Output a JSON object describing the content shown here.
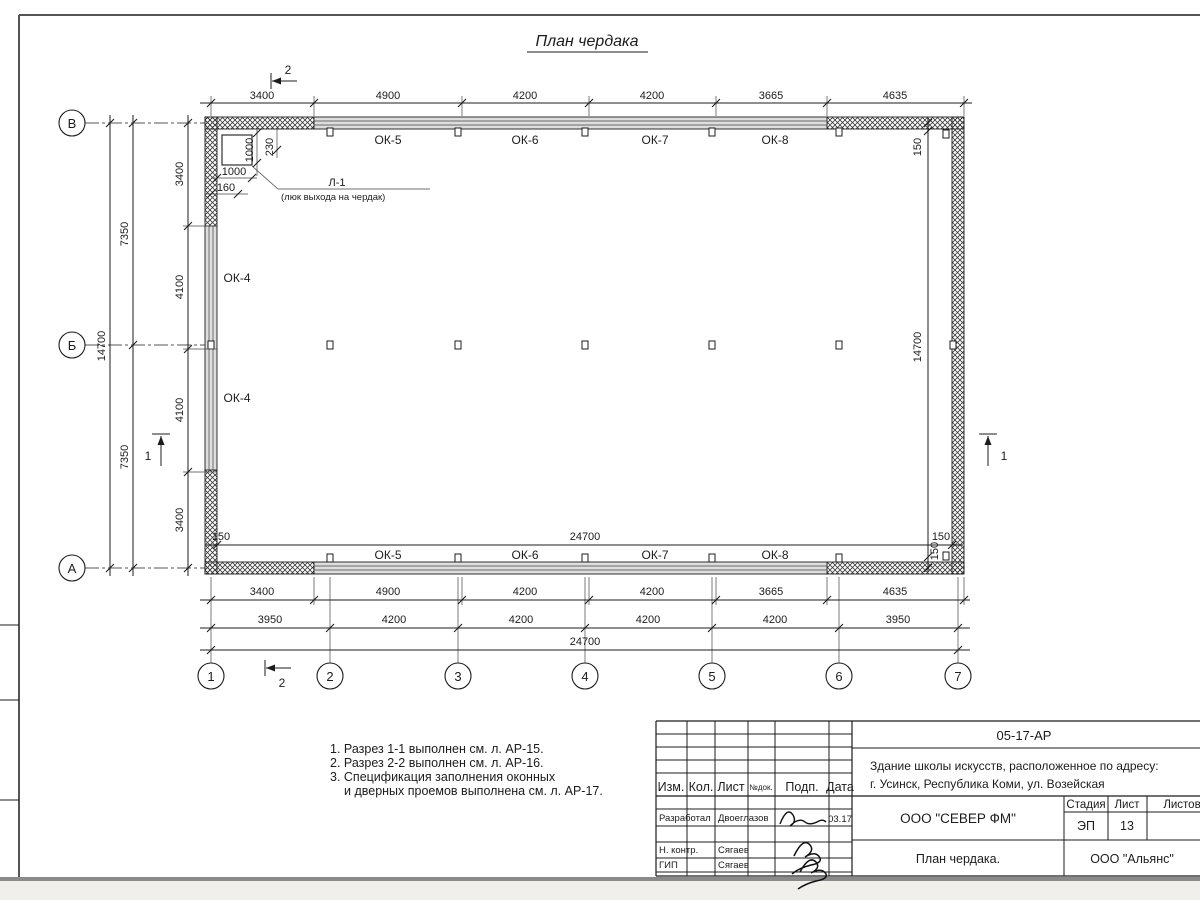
{
  "drawing": {
    "title": "План чердака"
  },
  "plan": {
    "axes_rows": [
      "В",
      "Б",
      "А"
    ],
    "axes_cols": [
      "1",
      "2",
      "3",
      "4",
      "5",
      "6",
      "7"
    ],
    "dims_top": [
      "3400",
      "4900",
      "4200",
      "4200",
      "3665",
      "4635"
    ],
    "dims_left_inner": [
      "3400",
      "4100",
      "4100",
      "3400"
    ],
    "dims_left_mid": [
      "7350",
      "7350"
    ],
    "dims_left_outer": "14700",
    "dims_right_inner": [
      "150",
      "14700",
      "150"
    ],
    "dims_inner_bottom": [
      "150",
      "24700",
      "150"
    ],
    "dims_bottom_row1": [
      "3400",
      "4900",
      "4200",
      "4200",
      "3665",
      "4635"
    ],
    "dims_bottom_row2": [
      "3950",
      "4200",
      "4200",
      "4200",
      "4200",
      "3950"
    ],
    "dims_bottom_total": "24700",
    "windows_top": [
      "ОК-5",
      "ОК-6",
      "ОК-7",
      "ОК-8"
    ],
    "windows_bottom": [
      "ОК-5",
      "ОК-6",
      "ОК-7",
      "ОК-8"
    ],
    "windows_left": [
      "ОК-4",
      "ОК-4"
    ],
    "roof_hatch": {
      "label": "Л-1",
      "note": "(люк выхода на чердак)",
      "dim_height": "1000",
      "dim_offset": "230",
      "dim_width": "1000",
      "dim_edge": "160"
    },
    "sections": {
      "s1": "1",
      "s2": "2"
    }
  },
  "notes": [
    "1. Разрез 1-1 выполнен см. л. АР-15.",
    "2. Разрез 2-2 выполнен см. л. АР-16.",
    "3. Спецификация заполнения оконных",
    "и дверных проемов выполнена см. л. АР-17."
  ],
  "titleblock": {
    "doc_code": "05-17-АР",
    "project_line1": "Здание школы искусств, расположенное по адресу:",
    "project_line2": "г. Усинск, Республика Коми, ул. Возейская",
    "cols": {
      "izm": "Изм.",
      "kol": "Кол.",
      "list": "Лист",
      "ndok": "№док.",
      "podp": "Подп.",
      "data": "Дата"
    },
    "rows": [
      {
        "role": "Разработал",
        "name": "Двоеглазов",
        "date": "03.17"
      },
      {
        "role": "Н. контр.",
        "name": "Сягаев"
      },
      {
        "role": "ГИП",
        "name": "Сягаев"
      }
    ],
    "stage_label": "Стадия",
    "sheet_label": "Лист",
    "sheets_label": "Листов",
    "stage_value": "ЭП",
    "sheet_value": "13",
    "company": "ООО \"СЕВЕР ФМ\"",
    "sheet_title": "План чердака.",
    "contractor": "ООО \"Альянс\""
  }
}
